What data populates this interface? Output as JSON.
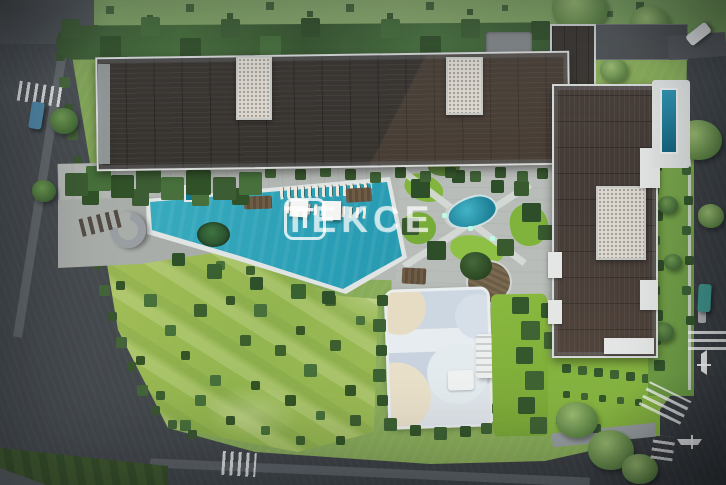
{
  "scene": {
    "alt": "Aerial 3D site-plan render of a residential complex: L-shaped apartment block with dark ribbed roof and white terraces, large turquoise swimming pool with palm island and water slide, landscaped courtyard with pond and round wooden deck, children's playground, wild-grass meadow, perimeter roads with crosswalks and three cars, TEKCE watermark in the center",
    "watermark": {
      "logo_letter": "T",
      "brand": "TEKCE"
    },
    "palette": {
      "pool_water": "#2a9cb4",
      "lap_pool_water": "#2e93b0",
      "lawn": "#87aa5b",
      "meadow": "#a3bd5e",
      "hedge_green": "#3c5c33",
      "roof_dark": "#37332f",
      "roof_brown": "#453c37",
      "white_trim": "#d9dcdb",
      "gravel_roof": "#dcd8d0",
      "road_asphalt": "#43484c",
      "deck_concrete": "#b7bbb7",
      "playground_surface": "#cbd5e0",
      "playground_sand": "#e6dcc4",
      "car_blue": "#4e86a6",
      "car_teal": "#3f948b",
      "car_white": "#e9ebec",
      "watermark_white": "#ffffff"
    }
  }
}
